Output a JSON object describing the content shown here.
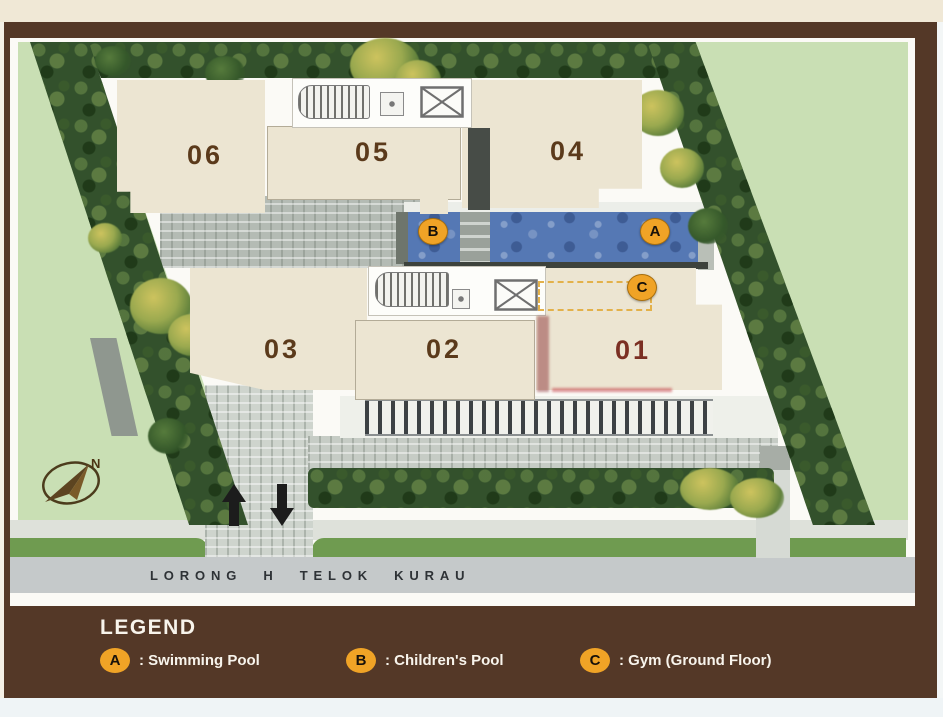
{
  "plan": {
    "units": [
      {
        "label": "06"
      },
      {
        "label": "05"
      },
      {
        "label": "04"
      },
      {
        "label": "03"
      },
      {
        "label": "02"
      },
      {
        "label": "01"
      }
    ],
    "markers": [
      {
        "letter": "A",
        "name": "swimming-pool"
      },
      {
        "letter": "B",
        "name": "childrens-pool"
      },
      {
        "letter": "C",
        "name": "gym"
      }
    ],
    "compass_label": "N",
    "road_name": "LORONG H TELOK KURAU"
  },
  "legend": {
    "title": "LEGEND",
    "items": [
      {
        "key": "A",
        "text": ": Swimming Pool"
      },
      {
        "key": "B",
        "text": ": Children's Pool"
      },
      {
        "key": "C",
        "text": ": Gym (Ground Floor)"
      }
    ]
  },
  "colors": {
    "frame_brown": "#543827",
    "marker_orange": "#f0a326",
    "pool_blue": "#5578b4",
    "lawn_green": "#c9dfb4",
    "hedge_green": "#33512c",
    "road_gray": "#c5c9ca",
    "building_cream": "#ece5d2",
    "unit_number_brown": "#5b3a1b"
  }
}
